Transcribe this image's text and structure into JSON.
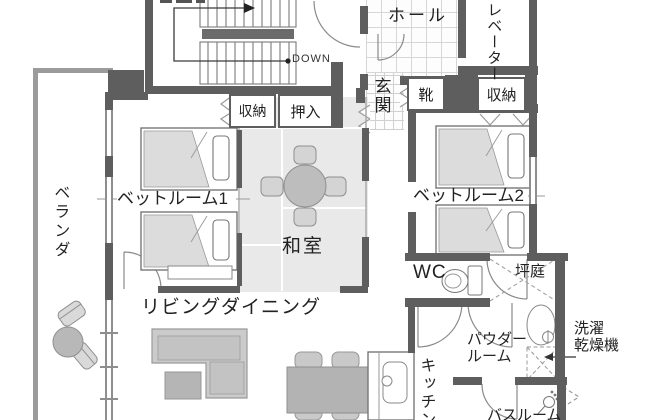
{
  "labels": {
    "hall": "ホール",
    "elevator": "エレベーター",
    "entrance": "玄関",
    "shoes": "靴",
    "storage_left": "収納",
    "closet": "押入",
    "storage_right": "収納",
    "bedroom1": "ベットルーム1",
    "bedroom2": "ベットルーム2",
    "japanese_room": "和室",
    "veranda": "ベランダ",
    "living_dining": "リビングダイニング",
    "wc": "WC",
    "courtyard": "坪庭",
    "powder_room_line1": "パウダー",
    "powder_room_line2": "ルーム",
    "laundry_line1": "洗濯",
    "laundry_line2": "乾燥機",
    "kitchen": "キッチン",
    "bathroom": "バスルーム",
    "stairs_down": "DOWN"
  },
  "colors": {
    "wall": "#5e5e5e",
    "veranda_border": "#9b9b9b",
    "tatami": "#e9e9e9",
    "bed_fill": "#dcdcdc",
    "furniture": "#c9c9c9",
    "furniture_dark": "#b3b3b3",
    "line": "#8c8c8c",
    "text": "#222222"
  }
}
